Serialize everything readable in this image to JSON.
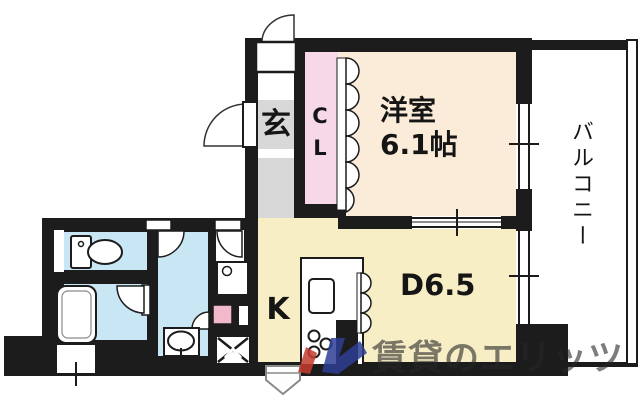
{
  "plan": {
    "entrance": {
      "label": "玄"
    },
    "closet": {
      "label": "CL"
    },
    "western_room": {
      "name": "洋室",
      "size": "6.1帖"
    },
    "dining": {
      "label": "D6.5"
    },
    "kitchen": {
      "label": "K"
    },
    "balcony": {
      "label": "バルコニー"
    }
  },
  "watermark": {
    "text": "賃貸のエリッツ"
  },
  "fixtures": [
    "entrance-door-swing",
    "front-door-swing",
    "washroom-door-swing",
    "utility-door-swing",
    "bathroom-door-swing",
    "hall-small-door-swing",
    "toilet",
    "bathtub",
    "washbasin",
    "washing-machine-pan",
    "gas-stove",
    "kitchen-counter",
    "kitchen-sink",
    "stove-burners",
    "closet-folding-door",
    "kitchen-folding-door",
    "window",
    "sliding-door",
    "balcony-railing",
    "meter-box",
    "water-heater"
  ],
  "colors": {
    "wall": "#1c1c1c",
    "room_western": "#faecd9",
    "room_ldk": "#f8eec5",
    "room_wet": "#c9e6f4",
    "closet_pink": "#f6d8e8",
    "entrance_gray": "#d8d8d8",
    "accent_pink": "#f2b9cb",
    "logo_red": "#c43b2f",
    "logo_blue": "#2e3f96"
  }
}
